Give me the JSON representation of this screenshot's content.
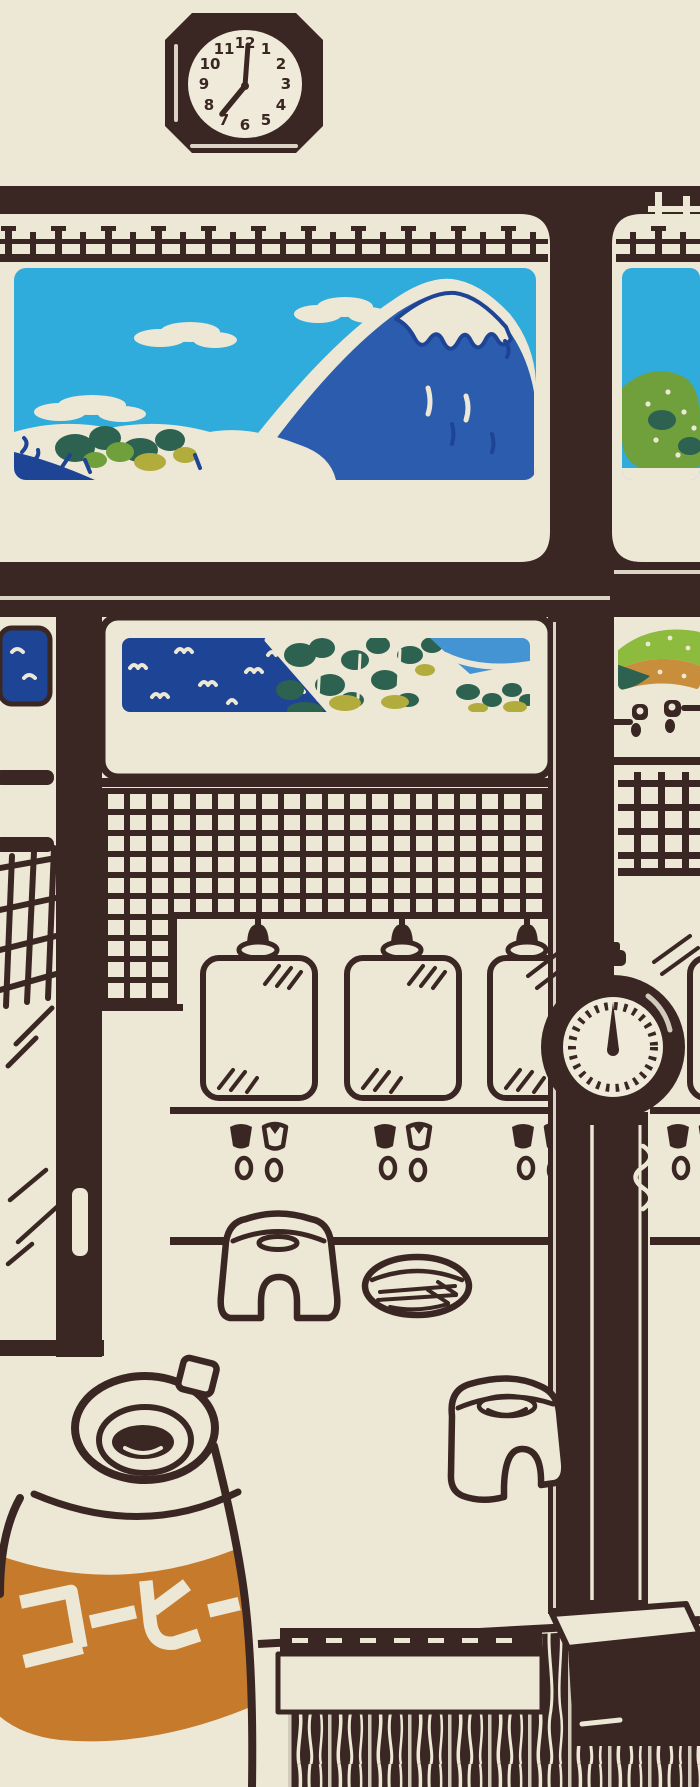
{
  "artwork": {
    "style": "woodblock-print bathhouse interior",
    "clock": {
      "numerals": [
        "12",
        "1",
        "2",
        "3",
        "4",
        "5",
        "6",
        "7",
        "8",
        "9",
        "10",
        "11"
      ],
      "time_shown": "7:00"
    },
    "jug": {
      "label": "コーヒー"
    },
    "palette": {
      "ink": "#3A2723",
      "cream": "#EDE7D5",
      "clockface": "#EFEAD9",
      "sky": "#2FABDC",
      "fuji": "#2B5CAD",
      "navy": "#1E4495",
      "ltblue": "#4493D3",
      "teal": "#2D6150",
      "grass": "#6FA03C",
      "khaki": "#B2AC3C",
      "orange": "#C67A2C",
      "rgreen": "#8CBB3D",
      "rorange": "#C98E3B"
    }
  }
}
